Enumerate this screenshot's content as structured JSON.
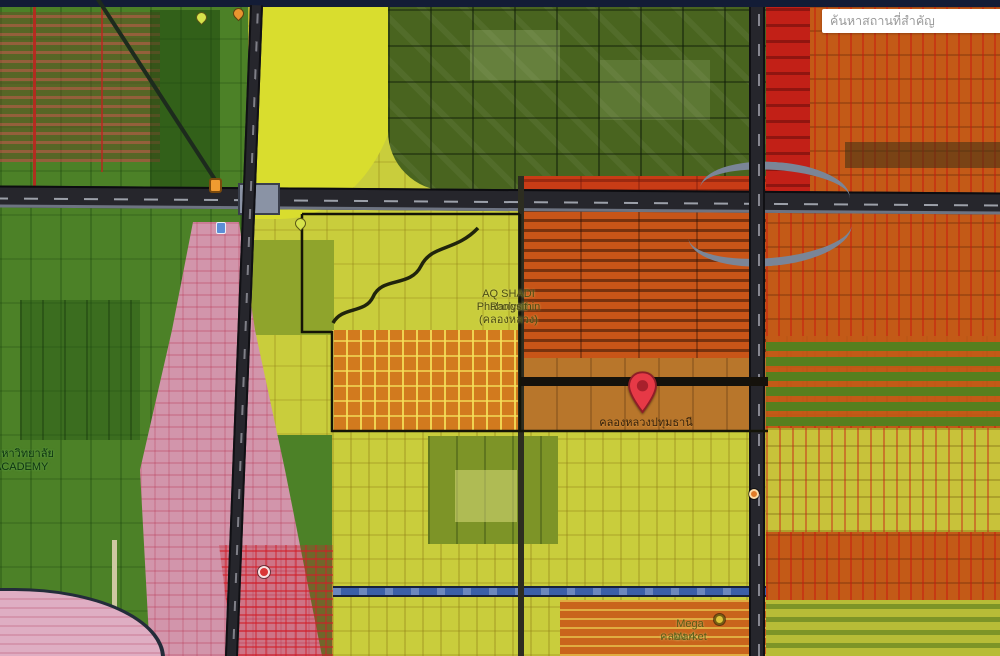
{
  "app": {
    "type": "city-zoning-map-viewer"
  },
  "search": {
    "placeholder": "ค้นหาสถานที่สำคัญ"
  },
  "pin": {
    "label": "คลองหลวงปทุมธานี"
  },
  "labels": {
    "project_line1": "AQ SHADI Phaholyothin",
    "project_line2": "Rangsit (คลองหลวง)",
    "academy_line1": "มหาวิทยาลัย",
    "academy_line2": "ACADEMY",
    "mega_line1": "Mega Market",
    "mega_line2": "คลอง 4"
  },
  "markers": [
    {
      "name": "destination-pin",
      "color": "#e63946"
    },
    {
      "name": "poi-pin-yellow",
      "color": "#d6e34b"
    },
    {
      "name": "poi-pin-orange",
      "color": "#e8952f"
    },
    {
      "name": "road-shield-marker",
      "color": "#f09b30"
    },
    {
      "name": "poi-marker-blue",
      "color": "#5b8ed6"
    },
    {
      "name": "poi-pin-yellow-2",
      "color": "#d6e34b"
    },
    {
      "name": "poi-dot-red",
      "color": "#d93636"
    },
    {
      "name": "poi-dot-orange",
      "color": "#e07b28"
    },
    {
      "name": "poi-dot-yellow",
      "color": "#ddc23a"
    }
  ],
  "zones": [
    {
      "name": "agricultural-green",
      "color": "#4c8127"
    },
    {
      "name": "campus-dark-green",
      "color": "#49641f"
    },
    {
      "name": "low-density-yellow",
      "color": "#c9cd3c"
    },
    {
      "name": "bright-yellow",
      "color": "#d9dd2e"
    },
    {
      "name": "medium-density-orange",
      "color": "#c85518"
    },
    {
      "name": "right-sector-orange",
      "color": "#c35a17"
    },
    {
      "name": "commercial-red",
      "color": "#c22017"
    },
    {
      "name": "residential-pink",
      "color": "#d295ab"
    },
    {
      "name": "pink-light",
      "color": "#dfaec3"
    },
    {
      "name": "parcel-tan",
      "color": "#b8762b"
    },
    {
      "name": "water-canal",
      "color": "#3b5fa8"
    }
  ],
  "colors": {
    "navy": "#131c36",
    "green": "#4c8127",
    "darkgreen": "#49641f",
    "yellow": "#c9cd3c",
    "yellow-bright": "#d9dd2e",
    "olive": "#8fa42c",
    "orange": "#c85518",
    "orange-right": "#c35a17",
    "red": "#c22017",
    "pink-light": "#dfaec3",
    "tan": "#b8762b",
    "water": "#3b5fa8",
    "road": "#26262c",
    "ramp": "#7a8597",
    "pin-red": "#e63946"
  }
}
